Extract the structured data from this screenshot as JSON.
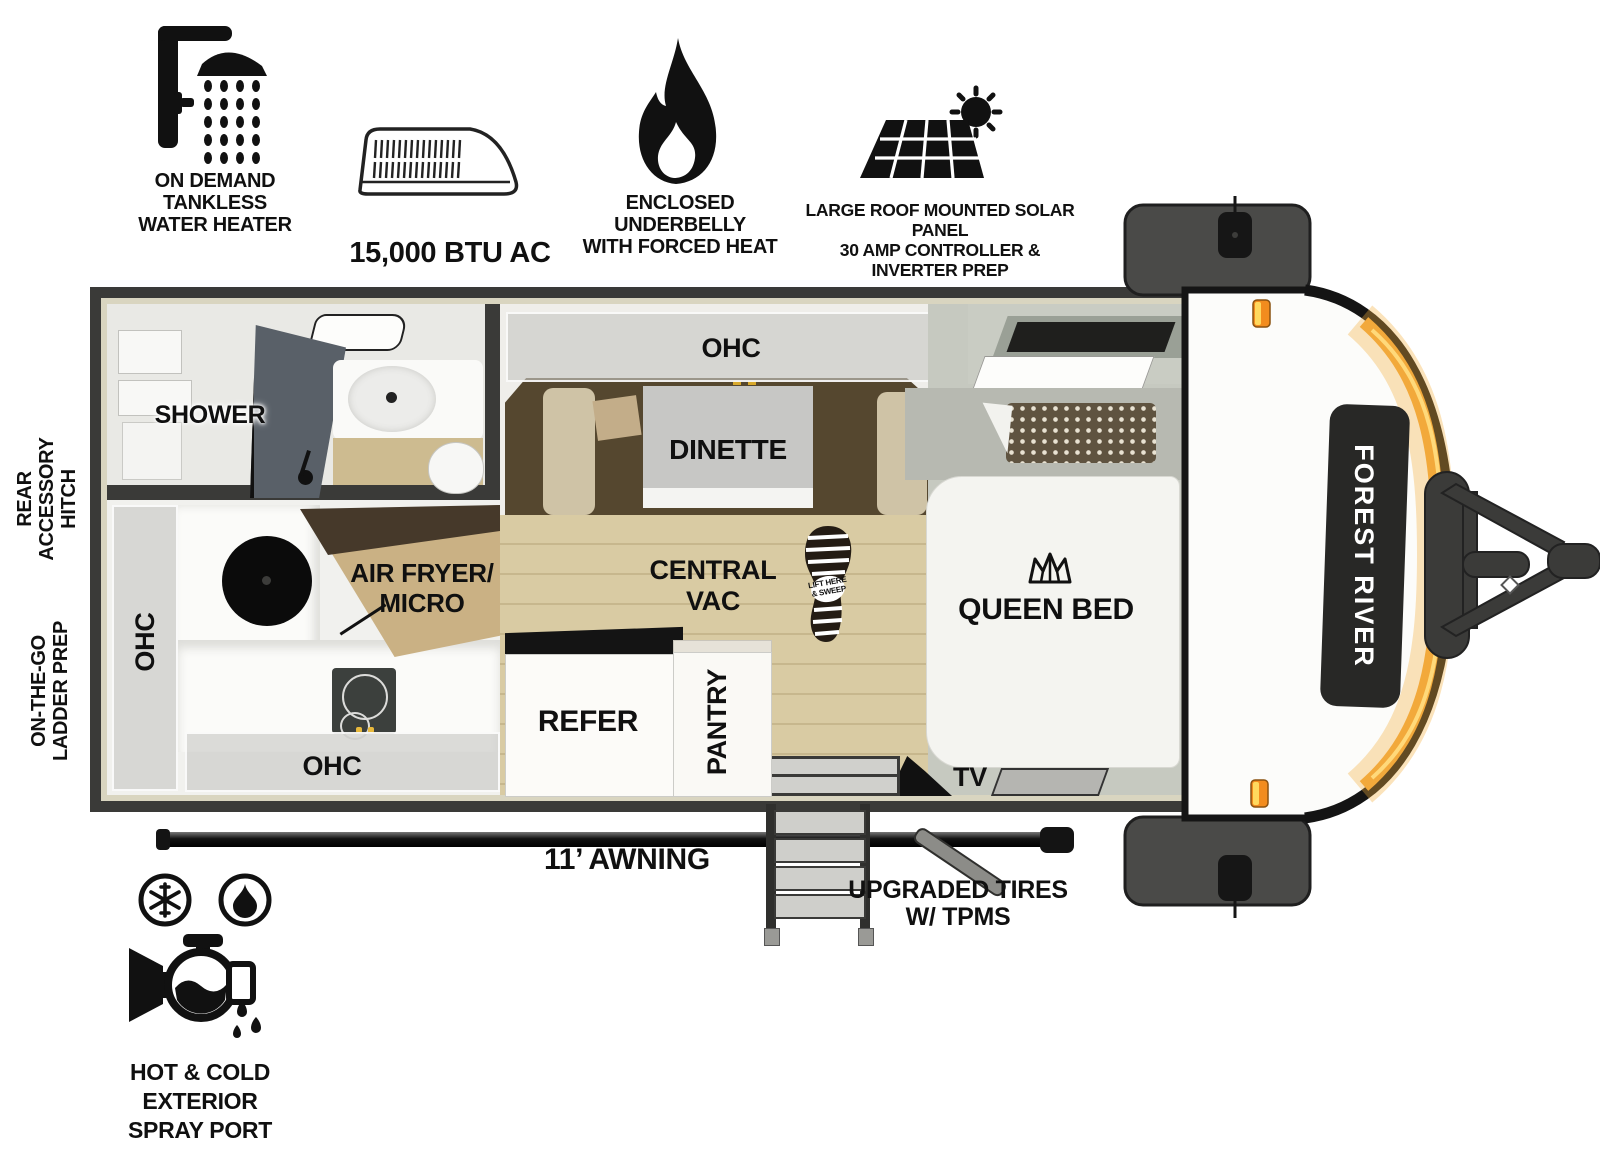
{
  "title": "Forest River travel trailer floorplan",
  "features": [
    {
      "icon": "shower-head-icon",
      "label": "ON DEMAND\nTANKLESS\nWATER HEATER"
    },
    {
      "icon": "ac-unit-icon",
      "label": "15,000 BTU AC"
    },
    {
      "icon": "flame-icon",
      "label": "ENCLOSED UNDERBELLY\nWITH FORCED HEAT"
    },
    {
      "icon": "solar-panel-icon",
      "label": "LARGE ROOF MOUNTED SOLAR PANEL\n30 AMP CONTROLLER & INVERTER PREP"
    }
  ],
  "exterior": {
    "rear_hitch": "REAR\nACCESSORY\nHITCH",
    "ladder_prep": "ON-THE-GO\nLADDER PREP",
    "awning": "11’ AWNING",
    "tires": "UPGRADED TIRES\nW/ TPMS",
    "spray_port": "HOT & COLD EXTERIOR\nSPRAY PORT",
    "brand": "FOREST RIVER"
  },
  "rooms": {
    "shower": "SHOWER",
    "dinette": "DINETTE",
    "dinette_ohc": "OHC",
    "kitchen_ohc_left": "OHC",
    "kitchen_ohc_bottom": "OHC",
    "air_fryer": "AIR FRYER/\nMICRO",
    "central_vac": "CENTRAL\nVAC",
    "vac_boot": "LIFT HERE\n& SWEEP",
    "queen_bed": "QUEEN BED",
    "refer": "REFER",
    "pantry": "PANTRY",
    "tv": "TV"
  },
  "colors": {
    "wall": "#3a3a38",
    "trim": "#d9d5c0",
    "wood_floor": "#d9cba3",
    "dinette_platform": "#55472f",
    "bench": "#cfc3a6",
    "bed_zone": "#c6c9c0",
    "accent_stripe": "#f2a93b",
    "marker_light": "#f28c1e",
    "badge": "#282826"
  }
}
